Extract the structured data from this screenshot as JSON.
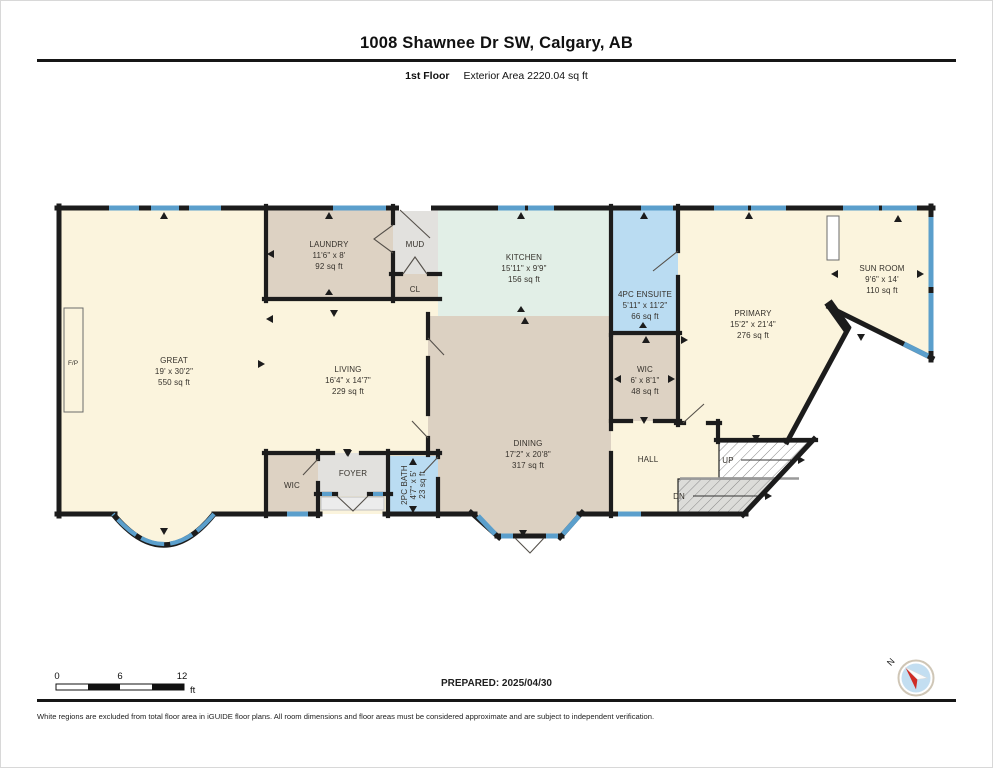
{
  "header": {
    "title": "1008 Shawnee Dr SW, Calgary, AB",
    "floor_label": "1st Floor",
    "area_label": "Exterior Area 2220.04 sq ft"
  },
  "rooms": {
    "great": {
      "name": "GREAT",
      "dims": "19' x 30'2\"",
      "area": "550 sq ft"
    },
    "living": {
      "name": "LIVING",
      "dims": "16'4\" x 14'7\"",
      "area": "229 sq ft"
    },
    "laundry": {
      "name": "LAUNDRY",
      "dims": "11'6\" x 8'",
      "area": "92 sq ft"
    },
    "mud": {
      "name": "MUD"
    },
    "closet": {
      "name": "CL"
    },
    "kitchen": {
      "name": "KITCHEN",
      "dims": "15'11\" x 9'9\"",
      "area": "156 sq ft"
    },
    "ensuite": {
      "name": "4PC ENSUITE",
      "dims": "5'11\" x 11'2\"",
      "area": "66 sq ft"
    },
    "wic": {
      "name": "WIC",
      "dims": "6' x 8'1\"",
      "area": "48 sq ft"
    },
    "primary": {
      "name": "PRIMARY",
      "dims": "15'2\" x 21'4\"",
      "area": "276 sq ft"
    },
    "sunroom": {
      "name": "SUN ROOM",
      "dims": "9'6\" x 14'",
      "area": "110 sq ft"
    },
    "dining": {
      "name": "DINING",
      "dims": "17'2\" x 20'8\"",
      "area": "317 sq ft"
    },
    "hall": {
      "name": "HALL"
    },
    "wic2": {
      "name": "WIC"
    },
    "foyer": {
      "name": "FOYER"
    },
    "bath": {
      "name": "2PC BATH",
      "dims": "4'7\" x 5'",
      "area": "23 sq ft"
    },
    "fireplace": {
      "name": "F/P"
    }
  },
  "stairs": {
    "up": "UP",
    "down": "DN"
  },
  "scale_bar": {
    "tick0": "0",
    "tick6": "6",
    "tick12": "12",
    "unit": "ft"
  },
  "footer": {
    "prepared": "PREPARED: 2025/04/30",
    "north": "N",
    "disclaimer": "White regions are excluded from total floor area in iGUIDE floor plans. All room dimensions and floor areas must be considered approximate and are subject to independent verification."
  },
  "colors": {
    "wall": "#1c1c1c",
    "window_blue": "#5b9fcc",
    "room_cream": "#fbf4dd",
    "room_tan": "#ddd2c3",
    "room_gray": "#e2e1de",
    "room_mint": "#e2efe7",
    "room_blue": "#badcf2",
    "north_red": "#cf2b24"
  }
}
